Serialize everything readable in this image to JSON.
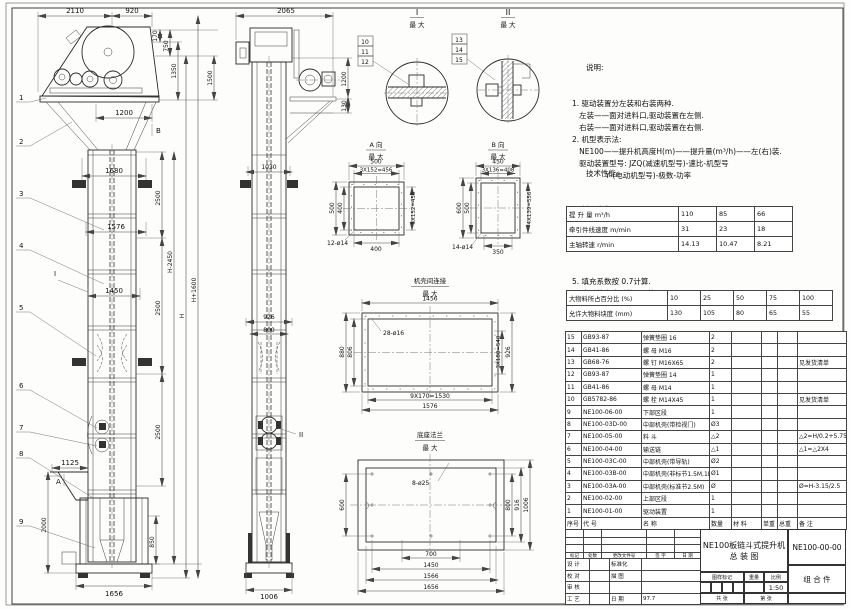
{
  "notes": {
    "heading": "说明:",
    "lines": [
      "1. 驱动装置分左装和右装两种.",
      "   左装——面对进料口,驱动装置在左侧.",
      "   右装——面对进料口,驱动装置在右侧.",
      "2. 机型表示法:",
      "   NE100——提升机高度H(m)——提升量(m³/h)——左(右)装.",
      "   驱动装置型号: JZQ(减速机型号)-速比-机型号",
      "              Y (电动机型号)-极数-功率"
    ]
  },
  "tech": {
    "heading": "技术性能:",
    "lines1": [
      "1. 料斗容积: 0.033 m³.",
      "2. 斗  距: 0.4 m.",
      "3. 斗  宽: 0.4 m.",
      "4. 提升量、牵引件线速度和主轴转速:"
    ],
    "table1": [
      [
        "提 升 量  m³/h",
        "110",
        "85",
        "66"
      ],
      [
        "牵引件线速度 m/min",
        "31",
        "23",
        "18"
      ],
      [
        "主轴转速  r/min",
        "14.13",
        "10.47",
        "8.21"
      ]
    ],
    "lines2": [
      "5. 填充系数按 0.7计算.",
      "6. 牵引件安全系数 >7倍.",
      "7. 物料块度:"
    ],
    "table2": [
      [
        "大物料所占百分比 (%)",
        "10",
        "25",
        "50",
        "75",
        "100"
      ],
      [
        "允许大物料块度 (mm)",
        "130",
        "105",
        "80",
        "65",
        "55"
      ]
    ]
  },
  "parts": {
    "rows": [
      [
        "15",
        "GB93-87",
        "弹簧垫圈 16",
        "2",
        "",
        "",
        "",
        ""
      ],
      [
        "14",
        "GB41-86",
        "螺 母  M16",
        "2",
        "",
        "",
        "",
        ""
      ],
      [
        "13",
        "GB68-76",
        "螺 钉  M16X65",
        "2",
        "",
        "",
        "",
        "见发货清单"
      ],
      [
        "12",
        "GB93-87",
        "弹簧垫圈 14",
        "1",
        "",
        "",
        "",
        ""
      ],
      [
        "11",
        "GB41-86",
        "螺 母  M14",
        "1",
        "",
        "",
        "",
        ""
      ],
      [
        "10",
        "GB5782-86",
        "螺 栓  M14X45",
        "1",
        "",
        "",
        "",
        "见发货清单"
      ],
      [
        "9",
        "NE100-06-00",
        "下部区段",
        "1",
        "",
        "",
        "",
        ""
      ],
      [
        "8",
        "NE100-03D-00",
        "中部机壳(带检视门)",
        "Ø3",
        "",
        "",
        "",
        ""
      ],
      [
        "7",
        "NE100-05-00",
        "料 斗",
        "△2",
        "",
        "",
        "",
        "△2=H/0.2+5.75"
      ],
      [
        "6",
        "NE100-04-00",
        "输送链",
        "△1",
        "",
        "",
        "",
        "△1=△2X4"
      ],
      [
        "5",
        "NE100-03C-00",
        "中部机壳(带导轨)",
        "Ø2",
        "",
        "",
        "",
        ""
      ],
      [
        "4",
        "NE100-03B-00",
        "中部机壳(非标节1.5M,1M)",
        "Ø1",
        "",
        "",
        "",
        ""
      ],
      [
        "3",
        "NE100-03A-00",
        "中部机壳(标准节2.5M)",
        "Ø",
        "",
        "",
        "",
        "Ø=H-3.15/2.5"
      ],
      [
        "2",
        "NE100-02-00",
        "上部区段",
        "1",
        "",
        "",
        "",
        ""
      ],
      [
        "1",
        "NE100-01-00",
        "驱动装置",
        "1",
        "",
        "",
        "",
        ""
      ]
    ],
    "header_row": [
      [
        "序号",
        "代  号",
        "名    称",
        "数量",
        "材  料",
        "单重",
        "总重",
        "备  注"
      ]
    ]
  },
  "tb": {
    "title1": "NE100板链斗式提升机",
    "title2": "总  装  图",
    "code": "NE100-00-00",
    "type": "组 合 件",
    "rev_header": [
      "标记",
      "处数",
      "更改文件号",
      "签 字",
      "日 期"
    ],
    "rev_empty": [
      [
        "",
        "",
        "",
        "",
        ""
      ],
      [
        "",
        "",
        "",
        "",
        ""
      ],
      [
        "",
        "",
        "",
        "",
        ""
      ]
    ],
    "sign_rows": [
      [
        "设 计",
        "",
        "标准化",
        ""
      ],
      [
        "校 对",
        "",
        "描 图",
        ""
      ],
      [
        "审 核",
        "",
        "",
        ""
      ],
      [
        "工 艺",
        "",
        "日 期",
        "97.7"
      ]
    ],
    "mark_lbl": "图样标记",
    "weight_lbl": "重量",
    "scale_lbl": "比例",
    "scale": "1:50",
    "sheets": "共  张",
    "sheet": "第  张"
  },
  "fv": {
    "d2110": "2110",
    "d920": "920",
    "d170": "170",
    "d750": "750",
    "d1350": "1350",
    "d1500": "1500",
    "d1200": "1200",
    "d1680": "1680",
    "d2500a": "2500",
    "d1576": "1576",
    "d1450": "1450",
    "d2500b": "2500",
    "d2500c": "2500",
    "d850": "850",
    "dHm": "H-2450",
    "dH": "H",
    "dHp": "H+1600",
    "d1125": "1125",
    "d2000": "2000",
    "d1656": "1656",
    "mA": "A",
    "mB": "B",
    "mI": "I"
  },
  "sv": {
    "d2065": "2065",
    "d1200": "1200",
    "d130": "130",
    "d1030": "1030",
    "d926": "926",
    "d800": "800",
    "d1006": "1006",
    "mII": "II"
  },
  "dA": {
    "t": "A 向",
    "max": "最 大",
    "d500t": "500",
    "dpt": "3X152=456",
    "d500l": "500",
    "d400l": "400",
    "dpr": "3X152=456",
    "d400b": "400",
    "holes": "12-ø14"
  },
  "dB": {
    "t": "B 向",
    "max": "最 大",
    "d450": "450",
    "dpt": "3X136=408",
    "d600": "600",
    "d500": "500",
    "dpr": "4X139=556",
    "d350": "350",
    "holes": "14-ø14"
  },
  "dC": {
    "t": "机壳间连接",
    "max": "最 大",
    "d1456": "1456",
    "d880": "880",
    "d806": "806",
    "holes": "28-ø16",
    "dpr": "3X180=540",
    "d926": "926",
    "dpb": "9X170=1530",
    "d1576": "1576"
  },
  "dD": {
    "t": "底座法兰",
    "max": "最 大",
    "d600": "600",
    "holes": "8-ø25",
    "d800": "800",
    "d916": "916",
    "d1006": "1006",
    "d700": "700",
    "d1450": "1450",
    "d1566": "1566",
    "d1656": "1656"
  },
  "det": {
    "i": "I",
    "ii": "II"
  },
  "bal": [
    "1",
    "2",
    "3",
    "4",
    "5",
    "6",
    "7",
    "8",
    "9",
    "10",
    "11",
    "12",
    "13",
    "14",
    "15"
  ]
}
